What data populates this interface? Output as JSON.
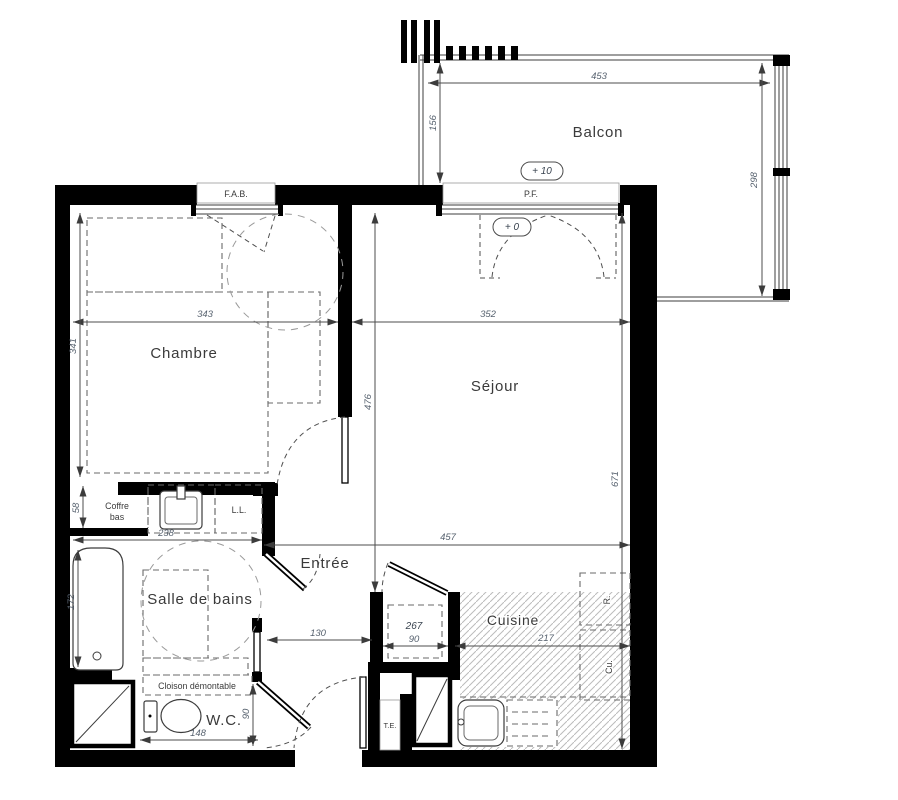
{
  "plan_type": "apartment-floor-plan",
  "colors": {
    "wall": "#000000",
    "line": "#3c3c3c",
    "dimension_text": "#56616e",
    "hatch": "#bcbcbc",
    "background": "#ffffff"
  },
  "labels": {
    "balcon": "Balcon",
    "chambre": "Chambre",
    "sejour": "Séjour",
    "entree": "Entrée",
    "sdb": "Salle de bains",
    "cuisine": "Cuisine",
    "wc": "W.C.",
    "fab": "F.A.B.",
    "pf": "P.F.",
    "niveau_balcon": "+ 10",
    "niveau_sejour": "+ 0",
    "ll": "L.L.",
    "coffre_line1": "Coffre",
    "coffre_line2": "bas",
    "cloison": "Cloison démontable",
    "te": "T.E.",
    "placard": "267",
    "refrigerateur": "R.",
    "cuisiniere": "Cu."
  },
  "dims": {
    "balcon_largeur": "453",
    "balcon_profondeur": "156",
    "balcon_hauteur": "298",
    "chambre_largeur": "343",
    "chambre_profondeur": "341",
    "sejour_largeur": "352",
    "sejour_profondeur": "476",
    "totale_profondeur": "671",
    "totale_largeur": "457",
    "coffre": "58",
    "sdb_largeur": "238",
    "baignoire": "172",
    "couloir": "130",
    "placard_largeur": "90",
    "cuisine_largeur": "217",
    "wc_largeur": "148",
    "wc_profondeur": "90"
  }
}
